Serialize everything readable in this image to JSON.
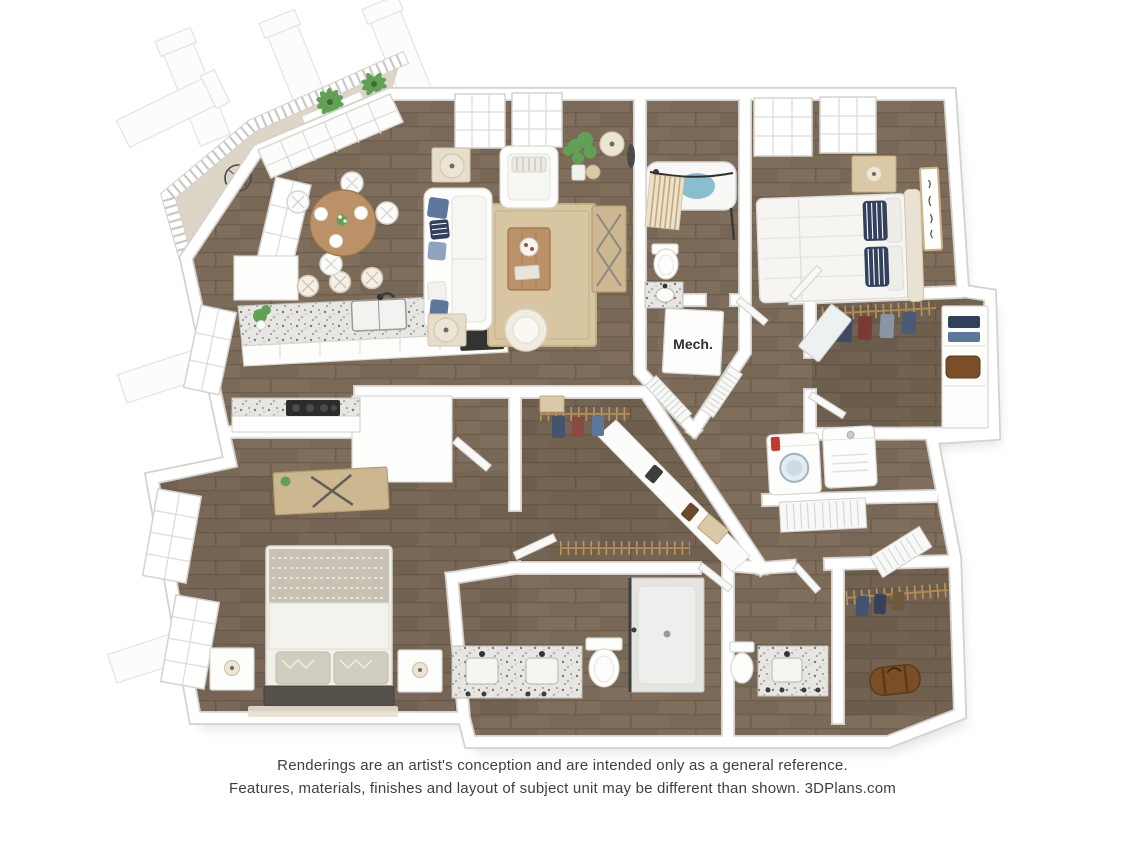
{
  "disclaimer": {
    "line1": "Renderings are an artist's conception and are intended only as a general reference.",
    "line2": "Features, materials, finishes and layout of subject unit may be different than shown. 3DPlans.com"
  },
  "labels": {
    "mech": "Mech."
  },
  "colors": {
    "background": "#ffffff",
    "wall_edge": "#d4d2ce",
    "wood_base": "#7f6e5c",
    "wood_line": "#6e5d4b",
    "wood_dark": "#5a4c3e",
    "balcony_floor": "#ddd6c7",
    "granite_base": "#e7e6e2",
    "granite_speck": "#7b7a73",
    "rug": "#d8c6a3",
    "accent_blue": "#5d7699",
    "navy": "#33415c",
    "water": "#8abdcf",
    "plant_green": "#61a156",
    "furn_wood": "#bb9268",
    "desk_wood": "#cdb790",
    "cream": "#ece5d4",
    "leather_brown": "#7a4f28",
    "text": "#3f3f3f"
  }
}
